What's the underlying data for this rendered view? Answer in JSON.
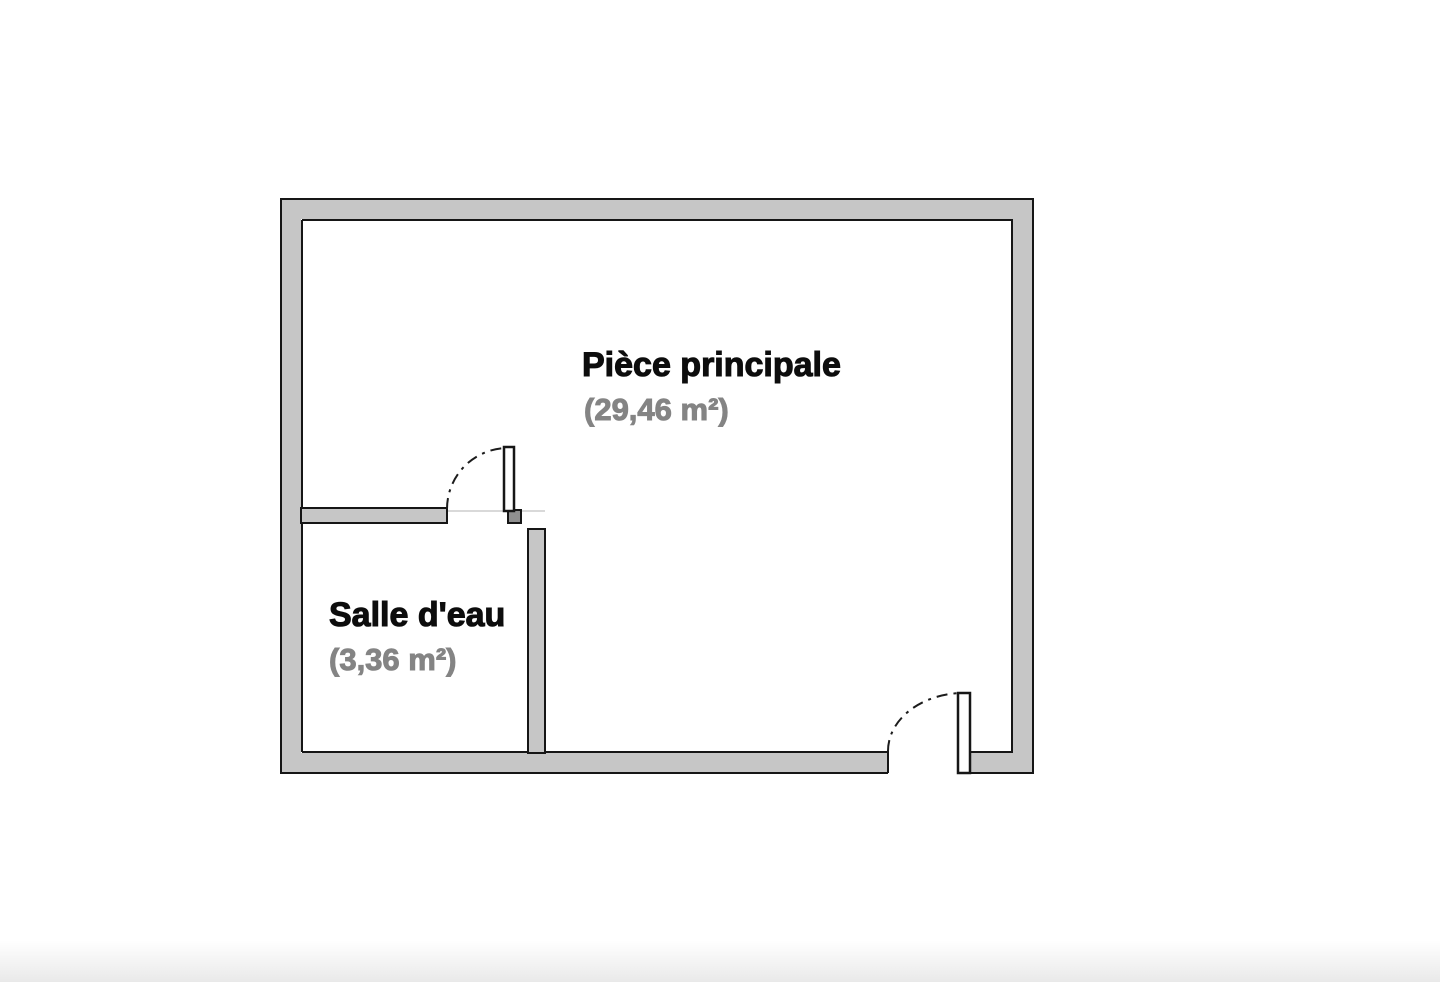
{
  "floorplan": {
    "rooms": [
      {
        "name": "Pièce principale",
        "area": "(29,46 m²)"
      },
      {
        "name": "Salle d'eau",
        "area": "(3,36 m²)"
      }
    ],
    "colors": {
      "wall_fill": "#c6c6c6",
      "wall_outline": "#161616",
      "room_name_text": "#0d0d0d",
      "area_text": "#848484",
      "door_leaf_fill": "#ffffff",
      "jamb_fill": "#8f8f8f",
      "threshold_line": "#d9d9d9",
      "background": "#ffffff"
    }
  }
}
